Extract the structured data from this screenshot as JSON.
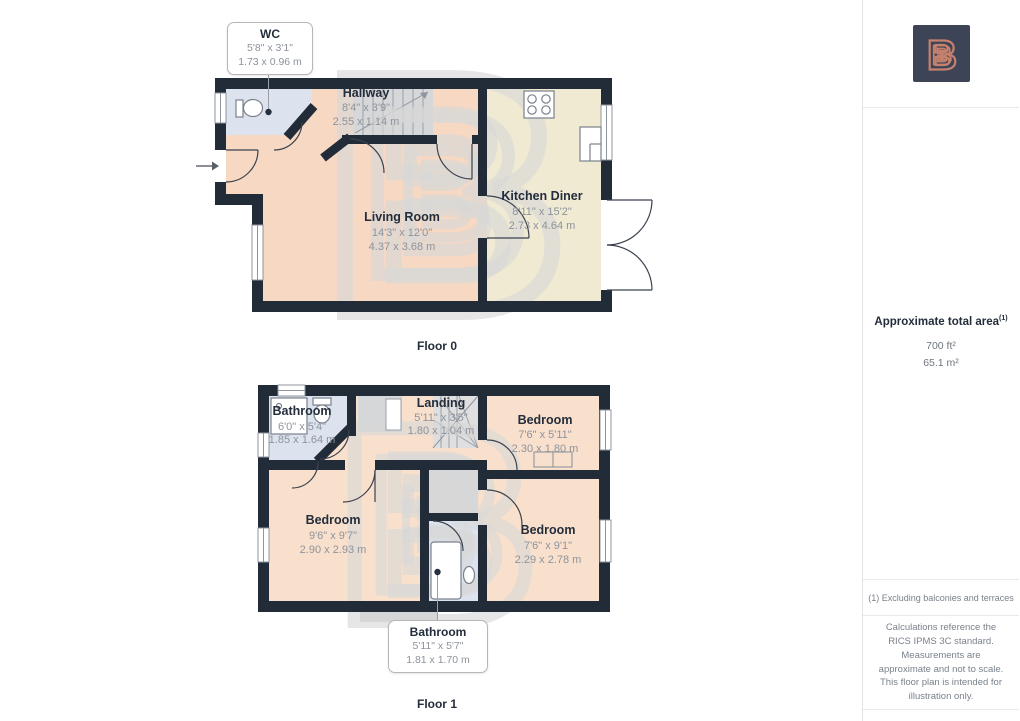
{
  "floor0": {
    "label": "Floor 0",
    "wc_callout": {
      "name": "WC",
      "imperial": "5'8\" x 3'1\"",
      "metric": "1.73 x 0.96 m"
    },
    "rooms": {
      "hallway": {
        "name": "Hallway",
        "imperial": "8'4\" x 3'9\"",
        "metric": "2.55 x 1.14 m"
      },
      "living_room": {
        "name": "Living Room",
        "imperial": "14'3\" x 12'0\"",
        "metric": "4.37 x 3.68 m"
      },
      "kitchen_diner": {
        "name": "Kitchen Diner",
        "imperial": "8'11\" x 15'2\"",
        "metric": "2.73 x 4.64 m"
      }
    }
  },
  "floor1": {
    "label": "Floor 1",
    "bathroom_callout": {
      "name": "Bathroom",
      "imperial": "5'11\" x 5'7\"",
      "metric": "1.81 x 1.70 m"
    },
    "rooms": {
      "bathroom": {
        "name": "Bathroom",
        "imperial": "6'0\" x 5'4\"",
        "metric": "1.85 x 1.64 m"
      },
      "landing": {
        "name": "Landing",
        "imperial": "5'11\" x 3'5\"",
        "metric": "1.80 x 1.04 m"
      },
      "bedroom_front": {
        "name": "Bedroom",
        "imperial": "7'6\" x 5'11\"",
        "metric": "2.30 x 1.80 m"
      },
      "bedroom_left": {
        "name": "Bedroom",
        "imperial": "9'6\" x 9'7\"",
        "metric": "2.90 x 2.93 m"
      },
      "bedroom_right": {
        "name": "Bedroom",
        "imperial": "7'6\" x 9'1\"",
        "metric": "2.29 x 2.78 m"
      }
    }
  },
  "sidebar": {
    "logo_letter": "B",
    "area_heading": "Approximate total area",
    "area_footnote_marker": "(1)",
    "area_imperial": "700 ft²",
    "area_metric": "65.1 m²",
    "footnote": "(1) Excluding balconies and terraces",
    "disclaimer": "Calculations reference the RICS IPMS 3C standard. Measurements are approximate and not to scale. This floor plan is intended for illustration only."
  },
  "colors": {
    "wall": "#222b38",
    "floor_warm": "#f6d8c3",
    "floor_warm_light": "#f9e0cd",
    "floor_kitchen": "#f0ead3",
    "floor_bath": "#dde3ee",
    "stairs_gray": "#d6d7d9",
    "logo_navy": "#3d4456",
    "logo_coral": "#c5806e"
  }
}
